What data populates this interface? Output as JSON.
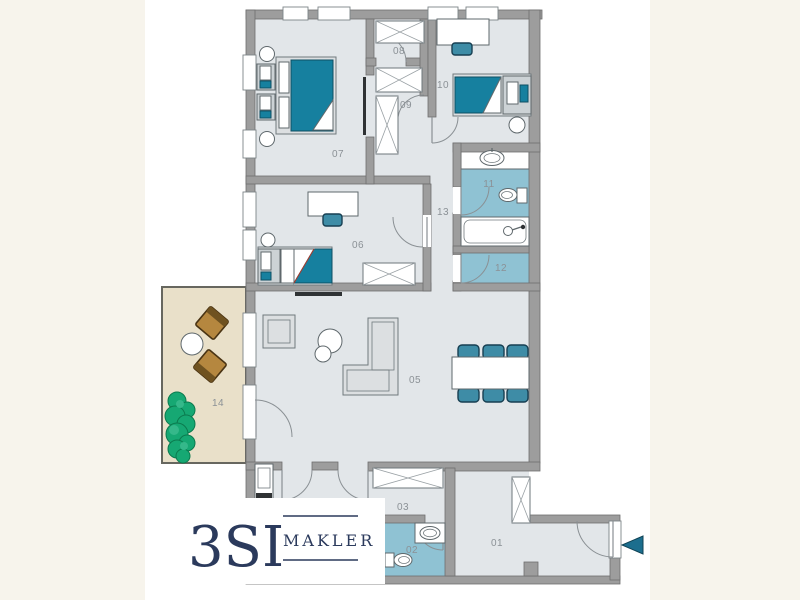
{
  "colors": {
    "page_background": "#f7f4ec",
    "canvas_background": "#ffffff",
    "wall": "#9d9d9d",
    "wall_stroke": "#6f6f6f",
    "floor": "#e2e6e9",
    "bath_floor": "#8fc2d3",
    "furniture_teal": "#16809f",
    "chair_teal": "#3e8ca6",
    "balcony_floor": "#e9e0c9",
    "wood": "#b5873f",
    "plant_green": "#16a873",
    "logo_navy": "#2b3a5c",
    "label_gray": "#8b9196",
    "arrow_teal": "#1c6e8e",
    "tv_dark": "#2f3234"
  },
  "rooms": {
    "01": {
      "label": "01"
    },
    "02": {
      "label": "02"
    },
    "03": {
      "label": "03"
    },
    "05": {
      "label": "05"
    },
    "06": {
      "label": "06"
    },
    "07": {
      "label": "07"
    },
    "08": {
      "label": "08"
    },
    "09": {
      "label": "09"
    },
    "10": {
      "label": "10"
    },
    "11": {
      "label": "11"
    },
    "12": {
      "label": "12"
    },
    "13": {
      "label": "13"
    },
    "14": {
      "label": "14"
    }
  },
  "logo": {
    "brand": "3SI",
    "subtitle": "MAKLER"
  }
}
